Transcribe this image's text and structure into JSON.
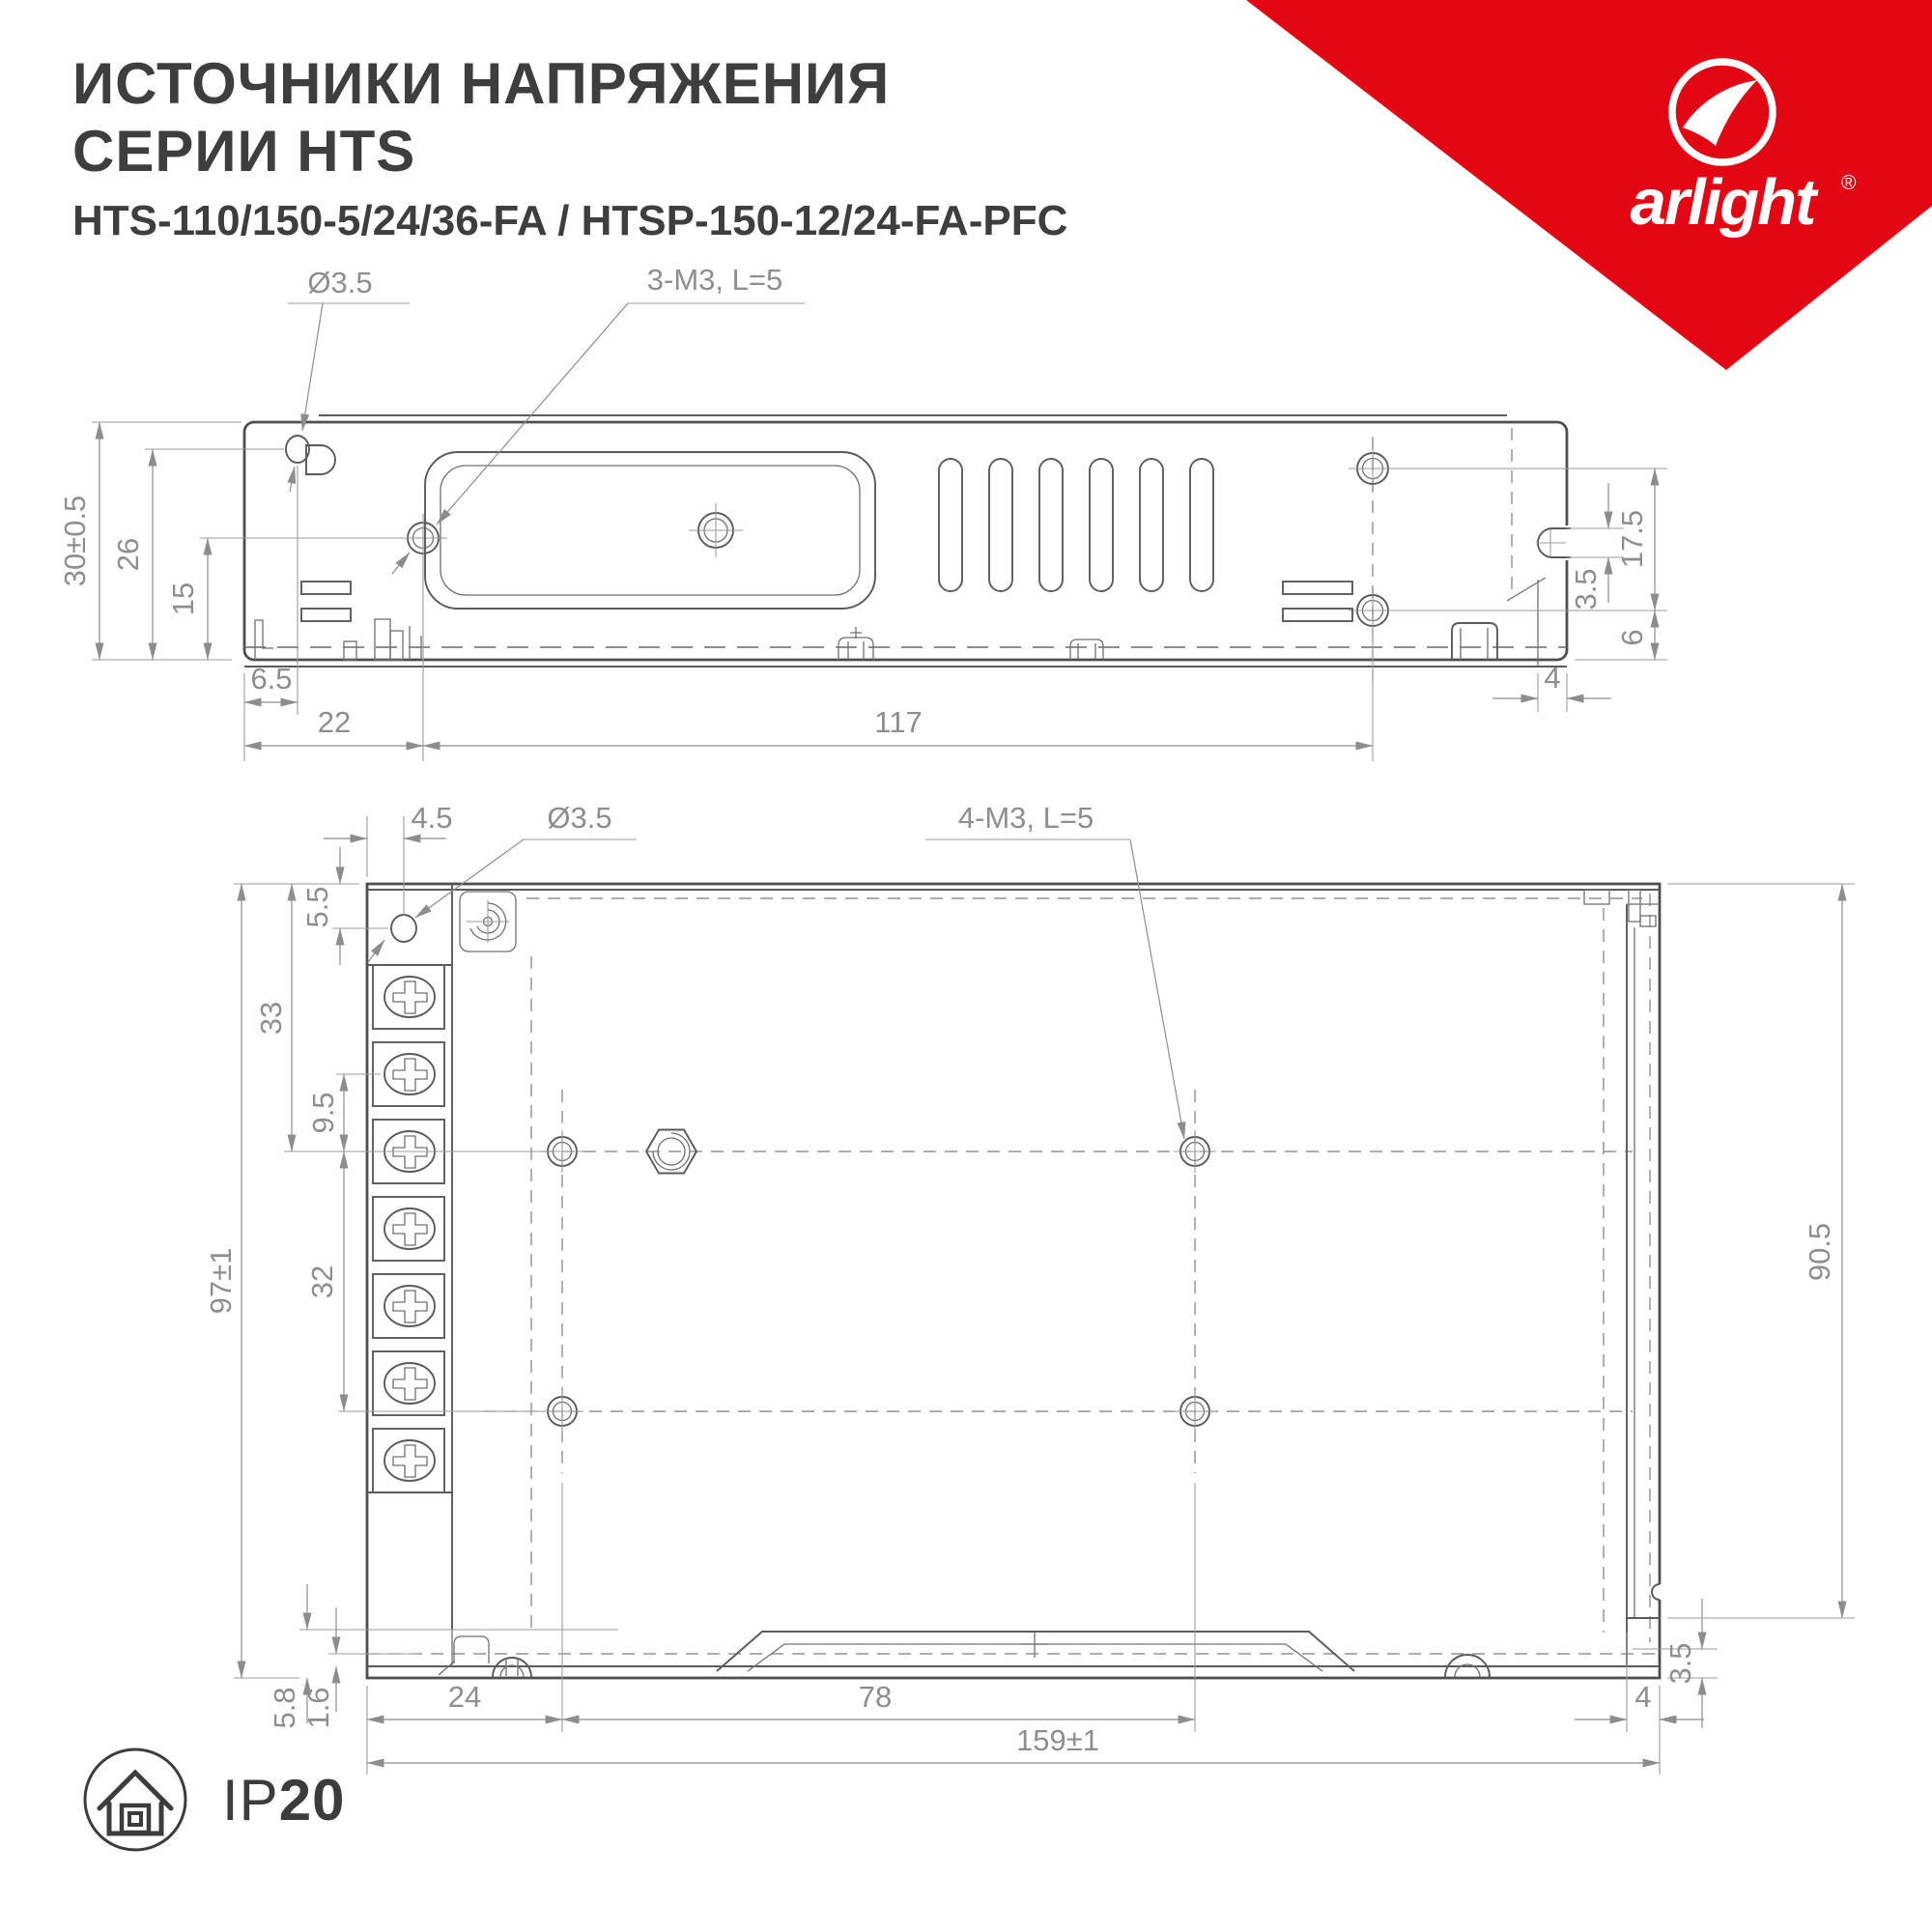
{
  "header": {
    "title_line1": "ИСТОЧНИКИ НАПРЯЖЕНИЯ",
    "title_line2": "СЕРИИ HTS",
    "subtitle": "HTS-110/150-5/24/36-FA / HTSP-150-12/24-FA-PFC"
  },
  "brand": {
    "name": "arlight",
    "registered": "®",
    "ribbon_color": "#e30613"
  },
  "icons": {
    "logo_mark": "arlight-swoosh-icon",
    "protection": "house-in-circle-icon",
    "fan_scroll": "spiral-symbol-icon"
  },
  "side_view": {
    "labels": {
      "hole_dia": "Ø3.5",
      "thread": "3-M3, L=5",
      "height_overall": "30±0.5",
      "h26": "26",
      "h15": "15",
      "w6_5": "6.5",
      "w22": "22",
      "w117": "117",
      "h17_5": "17.5",
      "h3_5": "3.5",
      "h6": "6",
      "w4": "4"
    }
  },
  "plan_view": {
    "labels": {
      "w4_5": "4.5",
      "hole_dia": "Ø3.5",
      "thread": "4-M3, L=5",
      "h5_5": "5.5",
      "h33": "33",
      "h9_5": "9.5",
      "height_overall": "97±1",
      "h32": "32",
      "h90_5": "90.5",
      "h5_8": "5.8",
      "h1_6": "1.6",
      "w24": "24",
      "w78": "78",
      "width_overall": "159±1",
      "w4": "4",
      "h3_5": "3.5"
    }
  },
  "footer": {
    "ip_prefix": "IP",
    "ip_value": "20"
  }
}
